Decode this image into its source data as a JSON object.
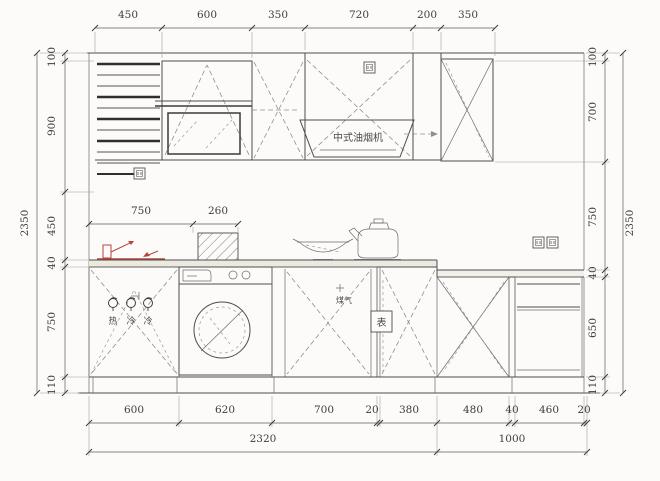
{
  "drawing": {
    "type": "kitchen-elevation-cad",
    "hood_label": "中式油烟机",
    "gas_label": "煤气",
    "meter_label": "表",
    "valve_labels": [
      "热",
      "冷",
      "冷"
    ]
  },
  "dims": {
    "top": [
      "450",
      "600",
      "350",
      "720",
      "200",
      "350"
    ],
    "left": [
      "100",
      "900",
      "450",
      "40",
      "750",
      "110"
    ],
    "left_total": "2350",
    "right": [
      "100",
      "700",
      "750",
      "40",
      "650",
      "110"
    ],
    "right_total": "2350",
    "mid": [
      "750",
      "260"
    ],
    "bottom": [
      "600",
      "620",
      "700",
      "20",
      "380",
      "480",
      "40",
      "460",
      "20"
    ],
    "bottom_totals": [
      "2320",
      "1000"
    ]
  },
  "colors": {
    "line": "#4c4c4c",
    "accent_red": "#b5443c",
    "background": "#fcfbf9"
  }
}
